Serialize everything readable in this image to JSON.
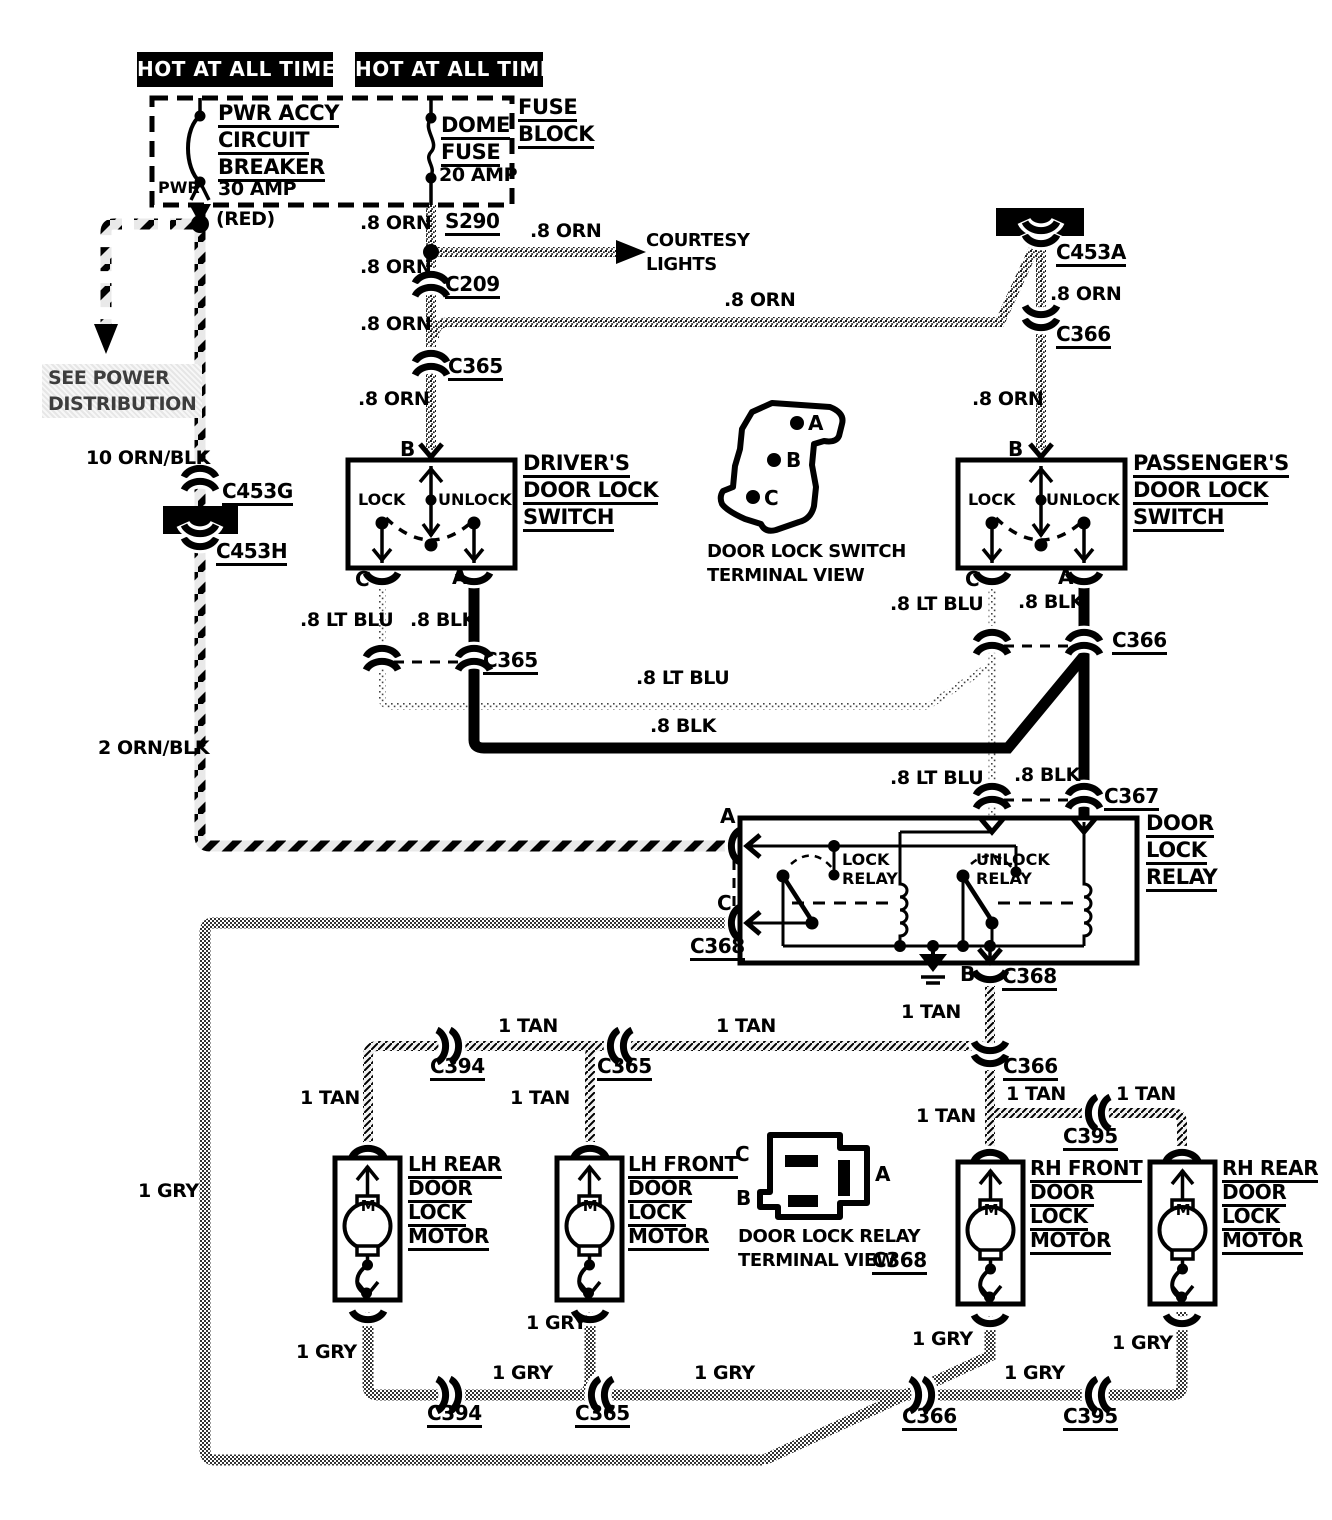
{
  "colors": {
    "ink": "#000000",
    "paper": "#ffffff"
  },
  "symbols_legend": [
    "inline-connector",
    "splice",
    "ground",
    "motor",
    "circuit-breaker",
    "fuse",
    "bulkhead-connector"
  ],
  "labels": [
    {
      "name": "hot-at-all-times-left",
      "cls": "hot",
      "x": 137,
      "y": 52,
      "w": 196,
      "text": "HOT AT ALL TIMES"
    },
    {
      "name": "hot-at-all-times-right",
      "cls": "hot",
      "x": 355,
      "y": 52,
      "w": 188,
      "text": "HOT AT ALL TIMES"
    },
    {
      "name": "fuse-block-label",
      "cls": "cmp",
      "x": 518,
      "y": 94,
      "lines": [
        "FUSE",
        "BLOCK"
      ]
    },
    {
      "name": "pwr-accy-breaker-label",
      "cls": "cmp",
      "x": 218,
      "y": 100,
      "lines": [
        "PWR ACCY",
        "CIRCUIT",
        "BREAKER"
      ]
    },
    {
      "name": "pwr-label",
      "cls": "inner",
      "x": 158,
      "y": 178,
      "text": "PWR"
    },
    {
      "name": "breaker-rating",
      "x": 218,
      "y": 178,
      "text": "30 AMP"
    },
    {
      "name": "red-wire-note",
      "x": 216,
      "y": 208,
      "text": "(RED)"
    },
    {
      "name": "dome-fuse-label",
      "cls": "cmp",
      "x": 441,
      "y": 112,
      "lines": [
        "DOME",
        "FUSE"
      ]
    },
    {
      "name": "dome-fuse-rating",
      "x": 439,
      "y": 164,
      "text": "20 AMP"
    },
    {
      "name": "wire-orn-1",
      "x": 360,
      "y": 212,
      "text": ".8 ORN"
    },
    {
      "name": "splice-s290",
      "cls": "cn",
      "x": 445,
      "y": 210,
      "text": "S290"
    },
    {
      "name": "wire-orn-2",
      "x": 530,
      "y": 220,
      "text": ".8 ORN"
    },
    {
      "name": "courtesy-lights-label",
      "cls": "cap",
      "x": 646,
      "y": 229,
      "lines": [
        "COURTESY",
        "LIGHTS"
      ]
    },
    {
      "name": "wire-orn-3",
      "x": 360,
      "y": 256,
      "text": ".8 ORN"
    },
    {
      "name": "connector-c209",
      "cls": "cn",
      "x": 445,
      "y": 273,
      "text": "C209"
    },
    {
      "name": "wire-orn-4",
      "x": 360,
      "y": 313,
      "text": ".8 ORN"
    },
    {
      "name": "wire-orn-5",
      "x": 724,
      "y": 289,
      "text": ".8 ORN"
    },
    {
      "name": "connector-c365-orn",
      "cls": "cn",
      "x": 448,
      "y": 355,
      "text": "C365"
    },
    {
      "name": "wire-orn-6",
      "x": 358,
      "y": 388,
      "text": ".8 ORN"
    },
    {
      "name": "connector-c453a",
      "cls": "cn",
      "x": 1056,
      "y": 241,
      "text": "C453A"
    },
    {
      "name": "wire-orn-7",
      "x": 1050,
      "y": 283,
      "text": ".8 ORN"
    },
    {
      "name": "connector-c366-orn",
      "cls": "cn",
      "x": 1056,
      "y": 323,
      "text": "C366"
    },
    {
      "name": "wire-orn-8",
      "x": 972,
      "y": 388,
      "text": ".8 ORN"
    },
    {
      "name": "see-power-distribution",
      "cls": "gray",
      "x": 42,
      "y": 364,
      "lines": [
        "SEE POWER",
        "DISTRIBUTION"
      ]
    },
    {
      "name": "wire-10-orn-blk",
      "x": 86,
      "y": 447,
      "text": "10 ORN/BLK"
    },
    {
      "name": "connector-c453g",
      "cls": "cn",
      "x": 222,
      "y": 480,
      "text": "C453G"
    },
    {
      "name": "connector-c453h",
      "cls": "cn",
      "x": 216,
      "y": 540,
      "text": "C453H"
    },
    {
      "name": "wire-2-orn-blk",
      "x": 98,
      "y": 737,
      "text": "2 ORN/BLK"
    },
    {
      "name": "drivers-switch-label",
      "cls": "cmp",
      "x": 523,
      "y": 450,
      "lines": [
        "DRIVER'S",
        "DOOR LOCK",
        "SWITCH"
      ]
    },
    {
      "name": "drivers-terminal-b",
      "cls": "term",
      "x": 400,
      "y": 438,
      "text": "B"
    },
    {
      "name": "drivers-lock-label",
      "cls": "inner",
      "x": 358,
      "y": 490,
      "text": "LOCK"
    },
    {
      "name": "drivers-unlock-label",
      "cls": "inner",
      "x": 438,
      "y": 490,
      "text": "UNLOCK"
    },
    {
      "name": "drivers-terminal-c",
      "cls": "term",
      "x": 355,
      "y": 568,
      "text": "C"
    },
    {
      "name": "drivers-terminal-a",
      "cls": "term",
      "x": 452,
      "y": 566,
      "text": "A"
    },
    {
      "name": "wire-ltblu-1",
      "x": 300,
      "y": 609,
      "text": ".8 LT BLU"
    },
    {
      "name": "wire-blk-1",
      "x": 410,
      "y": 609,
      "text": ".8 BLK"
    },
    {
      "name": "connector-c365-switch",
      "cls": "cn",
      "x": 483,
      "y": 649,
      "text": "C365"
    },
    {
      "name": "wire-ltblu-2",
      "x": 636,
      "y": 667,
      "text": ".8 LT BLU"
    },
    {
      "name": "wire-blk-2",
      "x": 650,
      "y": 715,
      "text": ".8 BLK"
    },
    {
      "name": "passengers-switch-label",
      "cls": "cmp",
      "x": 1133,
      "y": 450,
      "lines": [
        "PASSENGER'S",
        "DOOR LOCK",
        "SWITCH"
      ]
    },
    {
      "name": "passengers-terminal-b",
      "cls": "term",
      "x": 1008,
      "y": 438,
      "text": "B"
    },
    {
      "name": "passengers-lock-label",
      "cls": "inner",
      "x": 968,
      "y": 490,
      "text": "LOCK"
    },
    {
      "name": "passengers-unlock-label",
      "cls": "inner",
      "x": 1046,
      "y": 490,
      "text": "UNLOCK"
    },
    {
      "name": "passengers-terminal-c",
      "cls": "term",
      "x": 965,
      "y": 568,
      "text": "C"
    },
    {
      "name": "passengers-terminal-a",
      "cls": "term",
      "x": 1058,
      "y": 566,
      "text": "A"
    },
    {
      "name": "wire-ltblu-3",
      "x": 890,
      "y": 593,
      "text": ".8 LT BLU"
    },
    {
      "name": "wire-blk-3",
      "x": 1018,
      "y": 591,
      "text": ".8 BLK"
    },
    {
      "name": "connector-c366-switch",
      "cls": "cn",
      "x": 1112,
      "y": 629,
      "text": "C366"
    },
    {
      "name": "wire-ltblu-4",
      "x": 890,
      "y": 767,
      "text": ".8 LT BLU"
    },
    {
      "name": "wire-blk-4",
      "x": 1014,
      "y": 764,
      "text": ".8 BLK"
    },
    {
      "name": "connector-c367",
      "cls": "cn",
      "x": 1104,
      "y": 785,
      "text": "C367"
    },
    {
      "name": "terminal-view-a",
      "cls": "term",
      "x": 808,
      "y": 412,
      "text": "A"
    },
    {
      "name": "terminal-view-b",
      "cls": "term",
      "x": 786,
      "y": 449,
      "text": "B"
    },
    {
      "name": "terminal-view-c",
      "cls": "term",
      "x": 764,
      "y": 487,
      "text": "C"
    },
    {
      "name": "switch-terminal-view-caption",
      "cls": "cap",
      "x": 707,
      "y": 540,
      "lines": [
        "DOOR LOCK SWITCH",
        "TERMINAL VIEW"
      ]
    },
    {
      "name": "door-lock-relay-label",
      "cls": "cmp",
      "x": 1146,
      "y": 810,
      "lines": [
        "DOOR",
        "LOCK",
        "RELAY"
      ]
    },
    {
      "name": "relay-terminal-a",
      "cls": "term",
      "x": 720,
      "y": 805,
      "text": "A"
    },
    {
      "name": "relay-terminal-c",
      "cls": "term",
      "x": 717,
      "y": 892,
      "text": "C"
    },
    {
      "name": "connector-c368-left",
      "cls": "cn",
      "x": 690,
      "y": 935,
      "text": "C368"
    },
    {
      "name": "lock-relay-label",
      "cls": "inner",
      "x": 842,
      "y": 850,
      "lines": [
        "LOCK",
        "RELAY"
      ]
    },
    {
      "name": "unlock-relay-label",
      "cls": "inner",
      "x": 976,
      "y": 850,
      "lines": [
        "UNLOCK",
        "RELAY"
      ]
    },
    {
      "name": "relay-terminal-b",
      "cls": "term",
      "x": 960,
      "y": 963,
      "text": "B"
    },
    {
      "name": "connector-c368-bottom",
      "cls": "cn",
      "x": 1002,
      "y": 965,
      "text": "C368"
    },
    {
      "name": "wire-tan-1",
      "x": 901,
      "y": 1001,
      "text": "1 TAN"
    },
    {
      "name": "wire-tan-2",
      "x": 498,
      "y": 1015,
      "text": "1 TAN"
    },
    {
      "name": "wire-tan-3",
      "x": 716,
      "y": 1015,
      "text": "1 TAN"
    },
    {
      "name": "connector-c394-tan",
      "cls": "cn",
      "x": 430,
      "y": 1055,
      "text": "C394"
    },
    {
      "name": "connector-c365-tan",
      "cls": "cn",
      "x": 597,
      "y": 1055,
      "text": "C365"
    },
    {
      "name": "wire-tan-4",
      "x": 300,
      "y": 1087,
      "text": "1 TAN"
    },
    {
      "name": "wire-tan-5",
      "x": 510,
      "y": 1087,
      "text": "1 TAN"
    },
    {
      "name": "connector-c366-tan",
      "cls": "cn",
      "x": 1003,
      "y": 1055,
      "text": "C366"
    },
    {
      "name": "wire-tan-6",
      "x": 916,
      "y": 1105,
      "text": "1 TAN"
    },
    {
      "name": "wire-tan-7",
      "x": 1006,
      "y": 1083,
      "text": "1 TAN"
    },
    {
      "name": "wire-tan-8",
      "x": 1116,
      "y": 1083,
      "text": "1 TAN"
    },
    {
      "name": "connector-c395-tan",
      "cls": "cn",
      "x": 1063,
      "y": 1125,
      "text": "C395"
    },
    {
      "name": "lh-rear-motor-label",
      "cls": "mot",
      "x": 408,
      "y": 1152,
      "lines": [
        "LH REAR",
        "DOOR",
        "LOCK",
        "MOTOR"
      ]
    },
    {
      "name": "lh-front-motor-label",
      "cls": "mot",
      "x": 628,
      "y": 1152,
      "lines": [
        "LH FRONT",
        "DOOR",
        "LOCK",
        "MOTOR"
      ]
    },
    {
      "name": "rh-front-motor-label",
      "cls": "mot",
      "x": 1030,
      "y": 1156,
      "lines": [
        "RH FRONT",
        "DOOR",
        "LOCK",
        "MOTOR"
      ]
    },
    {
      "name": "rh-rear-motor-label",
      "cls": "mot",
      "x": 1222,
      "y": 1156,
      "lines": [
        "RH REAR",
        "DOOR",
        "LOCK",
        "MOTOR"
      ]
    },
    {
      "name": "lh-rear-motor-m",
      "cls": "mlabel",
      "x": 359,
      "y": 1195,
      "w": 18,
      "text": "M"
    },
    {
      "name": "lh-front-motor-m",
      "cls": "mlabel",
      "x": 581,
      "y": 1195,
      "w": 18,
      "text": "M"
    },
    {
      "name": "rh-front-motor-m",
      "cls": "mlabel",
      "x": 982,
      "y": 1199,
      "w": 18,
      "text": "M"
    },
    {
      "name": "rh-rear-motor-m",
      "cls": "mlabel",
      "x": 1174,
      "y": 1199,
      "w": 18,
      "text": "M"
    },
    {
      "name": "relay-view-c",
      "cls": "term",
      "x": 735,
      "y": 1143,
      "text": "C"
    },
    {
      "name": "relay-view-b",
      "cls": "term",
      "x": 736,
      "y": 1187,
      "text": "B"
    },
    {
      "name": "relay-view-a",
      "cls": "term",
      "x": 875,
      "y": 1163,
      "text": "A"
    },
    {
      "name": "relay-terminal-view-caption-1",
      "cls": "cap",
      "x": 738,
      "y": 1225,
      "text": "DOOR LOCK RELAY"
    },
    {
      "name": "relay-terminal-view-caption-2",
      "cls": "cap",
      "x": 738,
      "y": 1249,
      "text": "TERMINAL VIEW"
    },
    {
      "name": "relay-terminal-view-c368",
      "cls": "cn",
      "x": 872,
      "y": 1249,
      "text": "C368"
    },
    {
      "name": "wire-gry-1",
      "x": 138,
      "y": 1180,
      "text": "1 GRY"
    },
    {
      "name": "wire-gry-2",
      "x": 296,
      "y": 1341,
      "text": "1 GRY"
    },
    {
      "name": "wire-gry-3",
      "x": 526,
      "y": 1312,
      "text": "1 GRY"
    },
    {
      "name": "wire-gry-4",
      "x": 912,
      "y": 1328,
      "text": "1 GRY"
    },
    {
      "name": "wire-gry-5",
      "x": 1112,
      "y": 1332,
      "text": "1 GRY"
    },
    {
      "name": "wire-gry-6",
      "x": 492,
      "y": 1362,
      "text": "1 GRY"
    },
    {
      "name": "wire-gry-7",
      "x": 694,
      "y": 1362,
      "text": "1 GRY"
    },
    {
      "name": "wire-gry-8",
      "x": 1004,
      "y": 1362,
      "text": "1 GRY"
    },
    {
      "name": "connector-c394-gry",
      "cls": "cn",
      "x": 427,
      "y": 1402,
      "text": "C394"
    },
    {
      "name": "connector-c365-gry",
      "cls": "cn",
      "x": 575,
      "y": 1402,
      "text": "C365"
    },
    {
      "name": "connector-c366-gry",
      "cls": "cn",
      "x": 902,
      "y": 1405,
      "text": "C366"
    },
    {
      "name": "connector-c395-gry",
      "cls": "cn",
      "x": 1063,
      "y": 1405,
      "text": "C395"
    }
  ]
}
